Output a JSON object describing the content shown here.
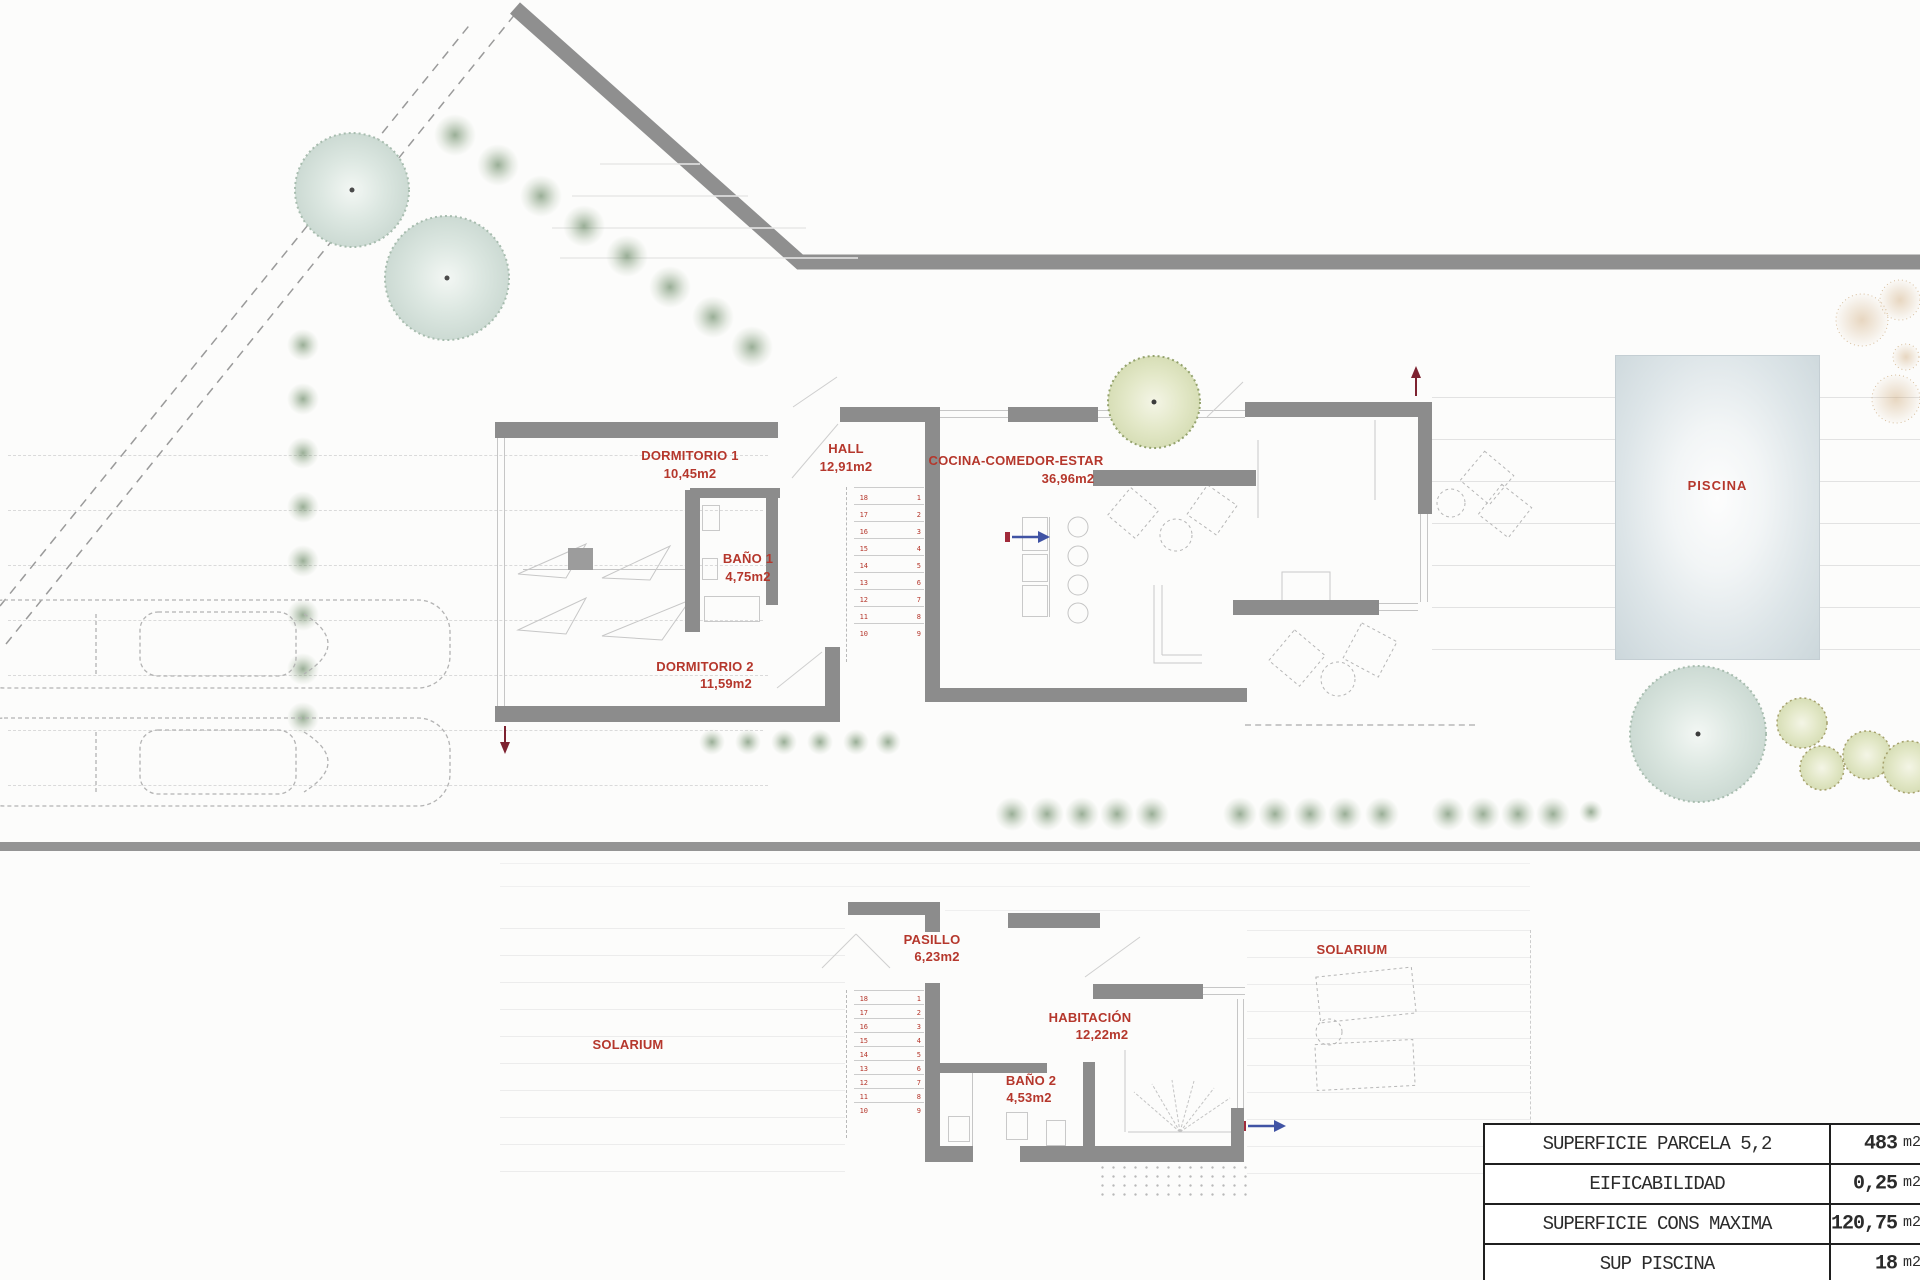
{
  "plan": {
    "ground_floor": {
      "rooms": {
        "dormitorio1": {
          "name": "DORMITORIO 1",
          "area": "10,45m2"
        },
        "hall": {
          "name": "HALL",
          "area": "12,91m2"
        },
        "cocina": {
          "name": "COCINA-COMEDOR-ESTAR",
          "area": "36,96m2"
        },
        "bano1": {
          "name": "BAÑO 1",
          "area": "4,75m2"
        },
        "dormitorio2": {
          "name": "DORMITORIO 2",
          "area": "11,59m2"
        }
      },
      "stairs": {
        "left": "18\n17\n16\n15\n14\n13\n12\n11 10",
        "right": "1\n2\n3\n4\n5\n6\n7\n8\n9"
      }
    },
    "first_floor": {
      "rooms": {
        "pasillo": {
          "name": "PASILLO",
          "area": "6,23m2"
        },
        "habitacion": {
          "name": "HABITACIÓN",
          "area": "12,22m2"
        },
        "bano2": {
          "name": "BAÑO 2",
          "area": "4,53m2"
        }
      },
      "solarium_left": "SOLARIUM",
      "solarium_right": "SOLARIUM",
      "stairs": {
        "left": "18\n17\n16\n15\n14\n13\n12\n11 10",
        "right": "1\n2\n3\n4\n5\n6\n7\n8\n9"
      }
    },
    "pool_label": "PISCINA"
  },
  "table": {
    "rows": [
      {
        "label": "SUPERFICIE PARCELA 5,2",
        "value": "483",
        "unit": "m2"
      },
      {
        "label": "EIFICABILIDAD",
        "value": "0,25",
        "unit": "m2"
      },
      {
        "label": "SUPERFICIE CONS MAXIMA",
        "value": "120,75",
        "unit": "m2"
      },
      {
        "label": "SUP PISCINA",
        "value": "18",
        "unit": "m2"
      }
    ]
  },
  "colors": {
    "wall": "#8c8c8c",
    "label_red": "#b5372c",
    "pool_edge": "#ccd7db"
  }
}
